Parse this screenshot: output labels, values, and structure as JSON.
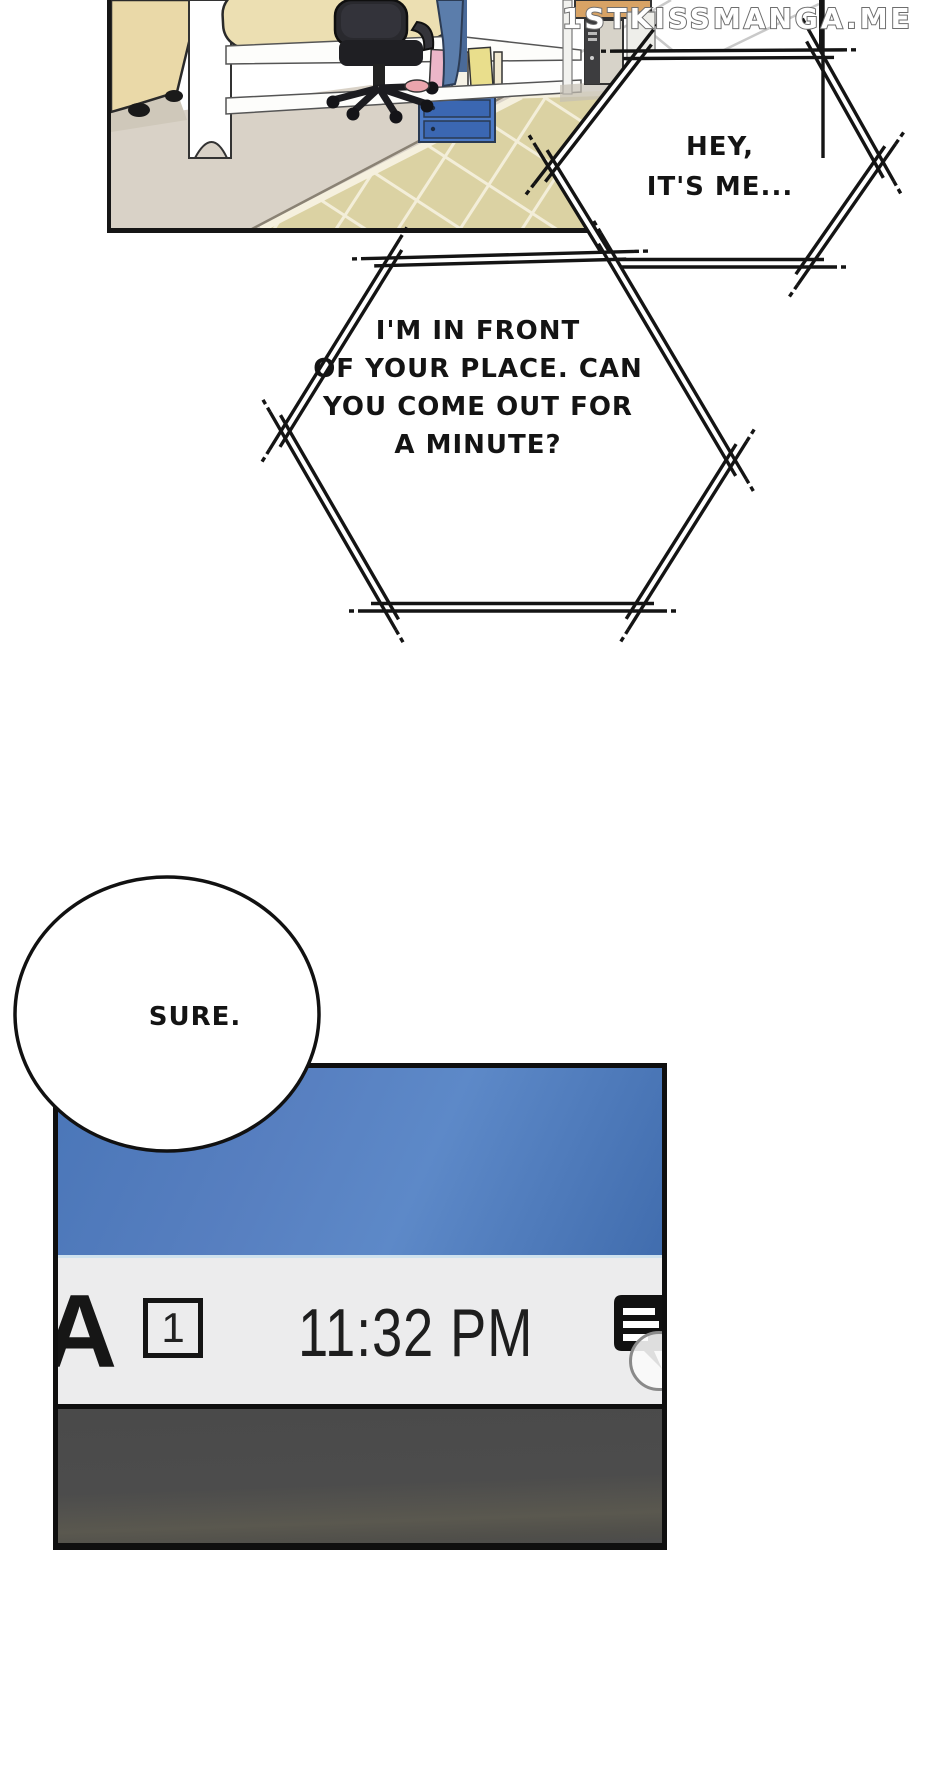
{
  "watermark": {
    "text": "1STKISSMANGA.ME"
  },
  "speech": {
    "hex1": {
      "line1": "HEY,",
      "line2": "IT'S ME..."
    },
    "hex2": {
      "line1": "I'M IN FRONT",
      "line2": "OF YOUR PLACE. CAN",
      "line3": "YOU COME OUT FOR",
      "line4": "A MINUTE?"
    },
    "sure": {
      "text": "SURE."
    }
  },
  "phone": {
    "cut_letter": "A",
    "notification_count": "1",
    "time": "11:32 PM"
  },
  "icons": {
    "message_icon": "black speech bubble with three white text lines",
    "notification_badge": "square outline containing count",
    "circle_overlay": "translucent circle over message icon"
  },
  "colors": {
    "screen_blue": "#4a76b8",
    "statusbar_gray": "#ececed",
    "bottom_bar_gray": "#4b4b4b",
    "rug_tan": "#dbd2a3",
    "bin_blue": "#4c7ac6",
    "ink": "#141414"
  }
}
